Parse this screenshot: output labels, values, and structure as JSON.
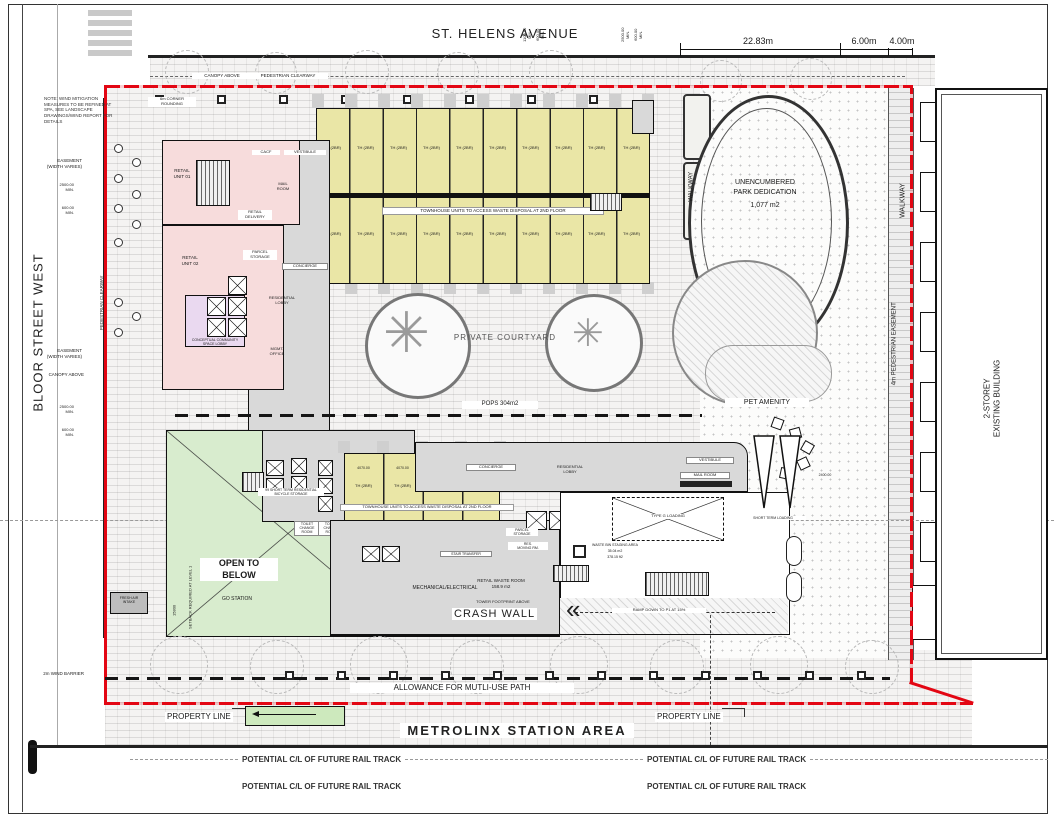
{
  "streets": {
    "st_helens": "ST. HELENS AVENUE",
    "bloor": "BLOOR STREET WEST",
    "existing_building": "2-STOREY\nEXISTING BUILDING",
    "metrolinx": "METROLINX STATION AREA"
  },
  "dims": {
    "d1": "22.83m",
    "d2": "6.00m",
    "d3": "4.00m",
    "min_2500": "2500.00\nMIN.",
    "min_600": "600.00\nMIN.",
    "min_1100": "1100.00\nMIN.",
    "th_dim": "4070.00",
    "loading_dim": "2400.00",
    "setback_dim": "15800"
  },
  "notes": {
    "wind": "NOTE: WIND MITIGATION\nMEASURES TO BE REFINED AT\nSPA, SEE LANDSCAPE\nDRAWINGS/WIND REPORT FOR\nDETAILS",
    "setback": "SETBACK REQUIRED AT LEVEL 1"
  },
  "top_labels": {
    "canopy": "CANOPY ABOVE",
    "clearway": "PEDESTRIAN CLEARWAY",
    "corner": "6m CORNER\nROUNDING"
  },
  "left_labels": {
    "easement": "EASEMENT\n(WIDTH VARIES)",
    "canopy": "CANOPY ABOVE",
    "clearway": "PEDESTRIAN CLEARWAY",
    "wind_barrier": "2m WIND BARRIER",
    "fresh_air": "FRESH AIR\nINTAKE"
  },
  "park": {
    "l1": "UNENCUMBERED",
    "l2": "PARK DEDICATION",
    "area": "1,077 m2",
    "walkway": "WALKWAY",
    "pet": "PET AMENITY"
  },
  "right_labels": {
    "walkway": "WALKWAY",
    "easement": "4m PEDESTRIAN EASEMENT"
  },
  "courtyard": {
    "label": "PRIVATE COURTYARD",
    "pops": "POPS 304m2"
  },
  "townhouses": {
    "note": "TOWNHOUSE UNITS TO ACCESS WASTE DISPOSAL AT 2ND FLOOR",
    "row1": [
      "TH (2BR)",
      "TH (2BR)",
      "TH (2BR)",
      "TH (2BR)",
      "TH (2BR)",
      "TH (2BR)",
      "TH (2BR)",
      "TH (2BR)",
      "TH (2BR)",
      "TH (2BR)"
    ],
    "row2": [
      "TH (2BR)",
      "TH (2BR)",
      "TH (2BR)",
      "TH (2BR)",
      "TH (2BR)",
      "TH (2BR)",
      "TH (2BR)",
      "TH (2BR)",
      "TH (2BR)",
      "TH (2BR)"
    ],
    "lower": [
      "TH (2BR)",
      "TH (2BR)",
      "TH (2BR)",
      "TH (2BR)"
    ]
  },
  "rooms": {
    "retail1": "RETAIL\nUNIT 01",
    "retail2": "RETAIL\nUNIT 02",
    "retail_delivery": "RETAIL\nDELIVERY",
    "parcel_storage": "PARCEL\nSTORAGE",
    "mail_room": "MAIL\nROOM",
    "cacf": "CACF",
    "vestibule": "VESTIBULE",
    "concierge": "CONCIERGE",
    "res_lobby": "RESIDENTIAL\nLOBBY",
    "mgmt": "MGMT.\nOFFICE",
    "community": "CONCEPTUAL COMMUNITY\nSPACE LOBBY"
  },
  "lower_rooms": {
    "open_below": "OPEN TO\nBELOW",
    "go": "GO STATION",
    "mech": "MECHANICAL/ELECTRICAL",
    "bike": "99 SHORT TERM RESIDENTIAL\nBICYCLE STORAGE",
    "toilet": "TOILET\nCHANGE\nROOM",
    "concierge": "CONCIERGE",
    "res_lobby": "RESIDENTIAL\nLOBBY",
    "vestibule": "VESTIBULE",
    "mail": "MAIL ROOM",
    "stair_transfer": "STAIR TRANSFER",
    "res_moving": "RES.\nMOVING RM.",
    "parcel": "PARCEL\nSTORAGE",
    "type_g": "TYPE G LOADING",
    "waste_bin": "WASTE BIN STAGING AREA",
    "waste_a1": "35.04 m2",
    "waste_a2": "378.15 ft2",
    "ramp": "RAMP DOWN TO P1 AT 15%",
    "crash": "CRASH WALL",
    "retail_waste": "RETAIL WASTE ROOM\n158.9 m2",
    "tower_footprint": "TOWER FOOTPRINT ABOVE",
    "short_loading": "SHORT TERM LOADING"
  },
  "bottom": {
    "path": "ALLOWANCE FOR MUTLI-USE PATH",
    "property": "PROPERTY LINE",
    "rail": "POTENTIAL C/L OF FUTURE RAIL TRACK"
  },
  "colors": {
    "property_red": "#e30613",
    "townhouse_yellow": "#eae6a6",
    "retail_pink": "#f7dcdc",
    "community_lavender": "#ead9f0",
    "open_green": "#d8ecce",
    "core_gray": "#d9d9d9"
  }
}
